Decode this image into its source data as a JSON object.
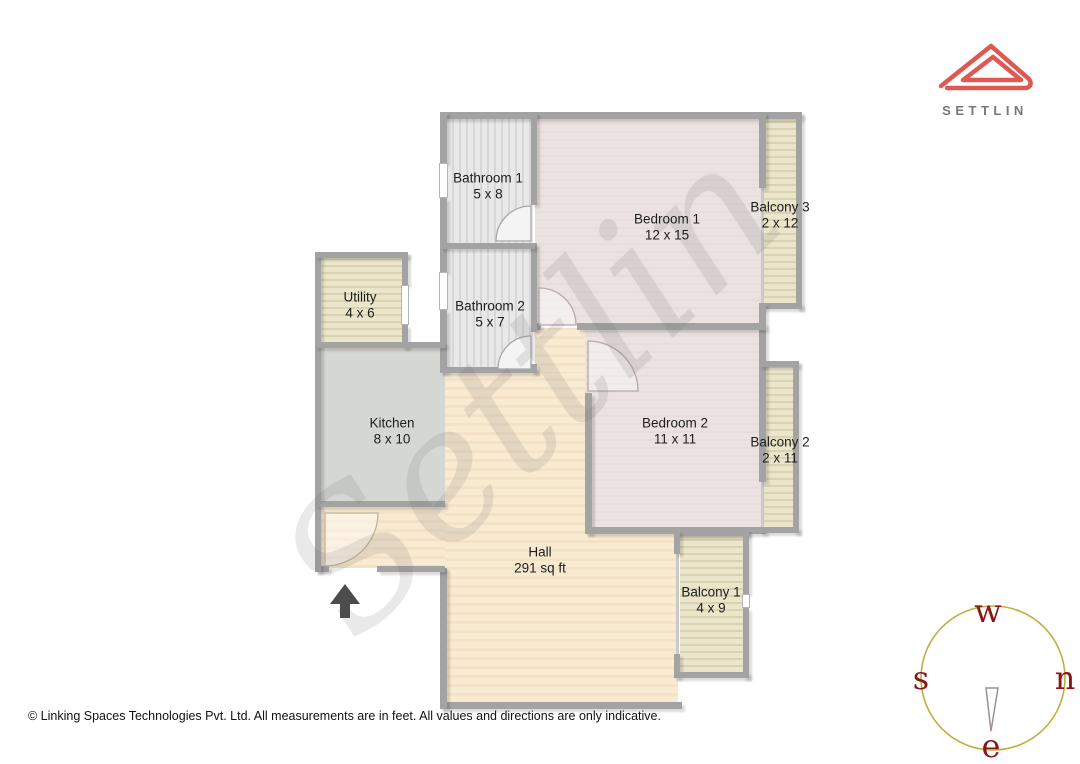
{
  "logo": {
    "brand": "SETTLIN"
  },
  "floorplan": {
    "watermark": "Settlin",
    "rooms": [
      {
        "name": "Bathroom 1",
        "size": "5 x 8"
      },
      {
        "name": "Bedroom 1",
        "size": "12 x 15"
      },
      {
        "name": "Balcony 3",
        "size": "2 x 12"
      },
      {
        "name": "Utility",
        "size": "4 x 6"
      },
      {
        "name": "Bathroom 2",
        "size": "5 x 7"
      },
      {
        "name": "Kitchen",
        "size": "8 x 10"
      },
      {
        "name": "Bedroom 2",
        "size": "11 x 11"
      },
      {
        "name": "Balcony 2",
        "size": "2 x 11"
      },
      {
        "name": "Hall",
        "size": "291 sq ft"
      },
      {
        "name": "Balcony 1",
        "size": "4 x 9"
      }
    ]
  },
  "compass": {
    "labels": {
      "top": "w",
      "right": "n",
      "bottom": "e",
      "left": "s"
    }
  },
  "footer": {
    "copyright": "© Linking Spaces Technologies Pvt. Ltd. All measurements are in feet. All values and directions are only indicative."
  },
  "colors": {
    "wall": "#a3a3a3",
    "bedroom_fill": "#ece2e2",
    "bathroom_fill": "#e8e8e8",
    "balcony_fill": "#eae5cb",
    "kitchen_fill": "#d5d7d2",
    "hall_fill": "#f9ead2",
    "logo_red": "#dd5a52",
    "compass_circle": "#bfae3e",
    "compass_letters": "#8b1414",
    "arrow": "#4c4c4c"
  }
}
